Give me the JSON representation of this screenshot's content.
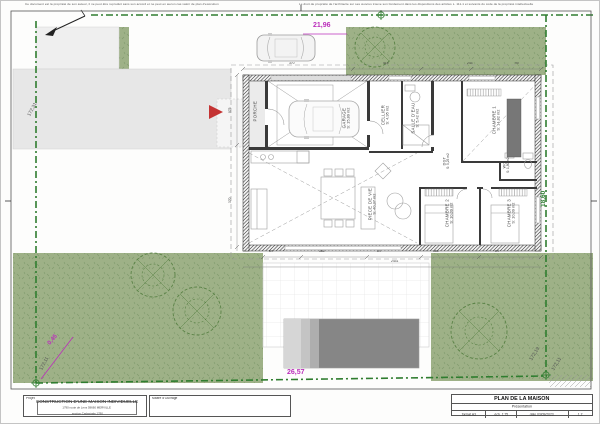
{
  "page": {
    "disclaimer_left": "Ce document est la propriété de son auteur, il ne peut être reproduit sans son accord et ne peut en aucun cas valoir de plan d'exécution",
    "disclaimer_right": "Le droit de propriété de l'architecte sur ses œuvres trouve son fondement dans les dispositions des articles L. 111-1 et suivants du code de la propriété intellectuelle"
  },
  "rooms": [
    {
      "name": "PORCHE",
      "area": ""
    },
    {
      "name": "GARAGE",
      "area": "S: 15,89 m2"
    },
    {
      "name": "CELLIER",
      "area": "S: 4,95 m2"
    },
    {
      "name": "SALLE D'EAU",
      "area": "S: 5,42 m2"
    },
    {
      "name": "CHAMBRE 1",
      "area": "S: 14,82 m2"
    },
    {
      "name": "DGT",
      "area": "S: 5,25 m2"
    },
    {
      "name": "WC",
      "area": "S: 1,80 m2"
    },
    {
      "name": "PIECE DE VIE",
      "area": "S: 40,37 m2"
    },
    {
      "name": "CHAMBRE 2",
      "area": "S: 10,09 m2"
    },
    {
      "name": "CHAMBRE 3",
      "area": "S: 10,09 m2"
    }
  ],
  "site_dims": {
    "top": "21,96",
    "bottom": "26,57",
    "corner": "0,45",
    "right": "18,60",
    "b1": "172,31",
    "b2": "172,11",
    "b3": "172,19",
    "b4": "172,11"
  },
  "plan_dims": {
    "t1": "370",
    "t2": "415",
    "t3": "243",
    "t4": "90",
    "l1": "975",
    "l2": "370",
    "c1": "84",
    "c2": "363",
    "c3": "84",
    "c4": "363",
    "c5": "84",
    "total": "2431"
  },
  "titleblock": {
    "project_label": "Projet",
    "project_title": "CONSTRUCTION D'UNE MAISON INDIVIDUELLE",
    "project_addr1": "1790 route de Lens 59660 MERVILLE",
    "project_addr2": "section Cadastrale 1790",
    "owner_label": "Maître d'Ouvrage",
    "doc_title": "PLAN DE LA MAISON",
    "doc_subtitle": "Présentation",
    "format": "format A3",
    "scale": "éch. 1:75",
    "date": "date 03/09/2023",
    "index": "1.2"
  },
  "colors": {
    "grass": "#9eb187",
    "boundary_green": "#2f7d2f",
    "dim_magenta": "#bb2fbb",
    "dim_green": "#2e7d32",
    "wall": "#2a2a2a",
    "driveway": "#e7e7e7",
    "pool": "#868686",
    "entrance_arrow_red": "#c43333"
  }
}
